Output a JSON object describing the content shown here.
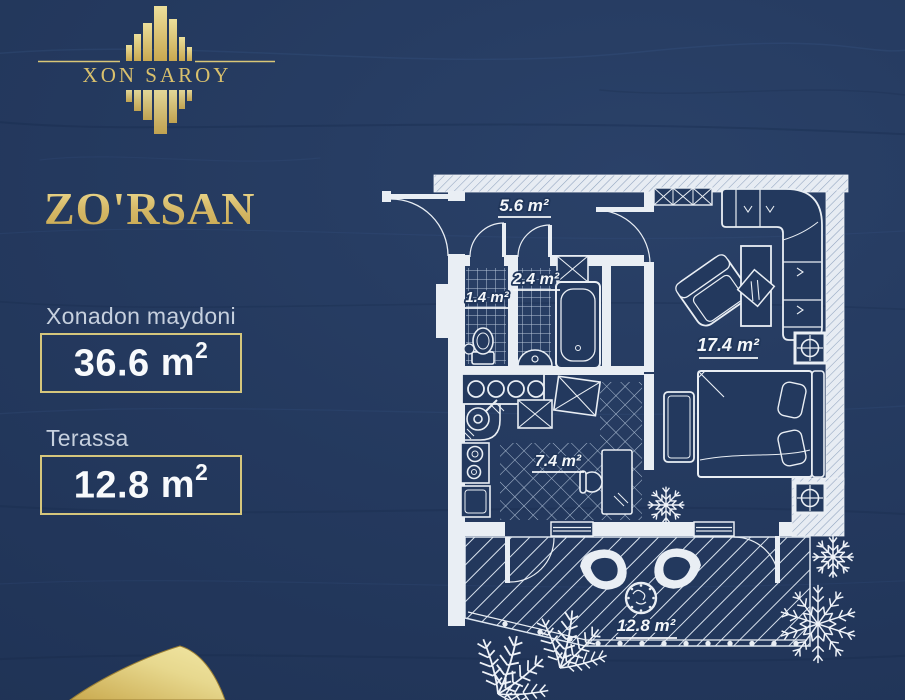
{
  "brand": {
    "name": "XON SAROY"
  },
  "title": "ZO'RSAN",
  "stats": [
    {
      "label": "Xonadon maydoni",
      "value": "36.6",
      "unit": "m",
      "sup": "2"
    },
    {
      "label": "Terassa",
      "value": "12.8",
      "unit": "m",
      "sup": "2"
    }
  ],
  "floorplan": {
    "rooms": [
      {
        "name": "hallway",
        "area": "5.6 m²"
      },
      {
        "name": "wc",
        "area": "1.4 m²"
      },
      {
        "name": "bathroom",
        "area": "2.4 m²"
      },
      {
        "name": "living-bedroom",
        "area": "17.4 m²"
      },
      {
        "name": "kitchen",
        "area": "7.4 m²"
      },
      {
        "name": "terrace",
        "area": "12.8 m²"
      }
    ]
  },
  "colors": {
    "background": "#23395e",
    "gold": "#d8bf70",
    "plan_line": "#e9eef5"
  }
}
